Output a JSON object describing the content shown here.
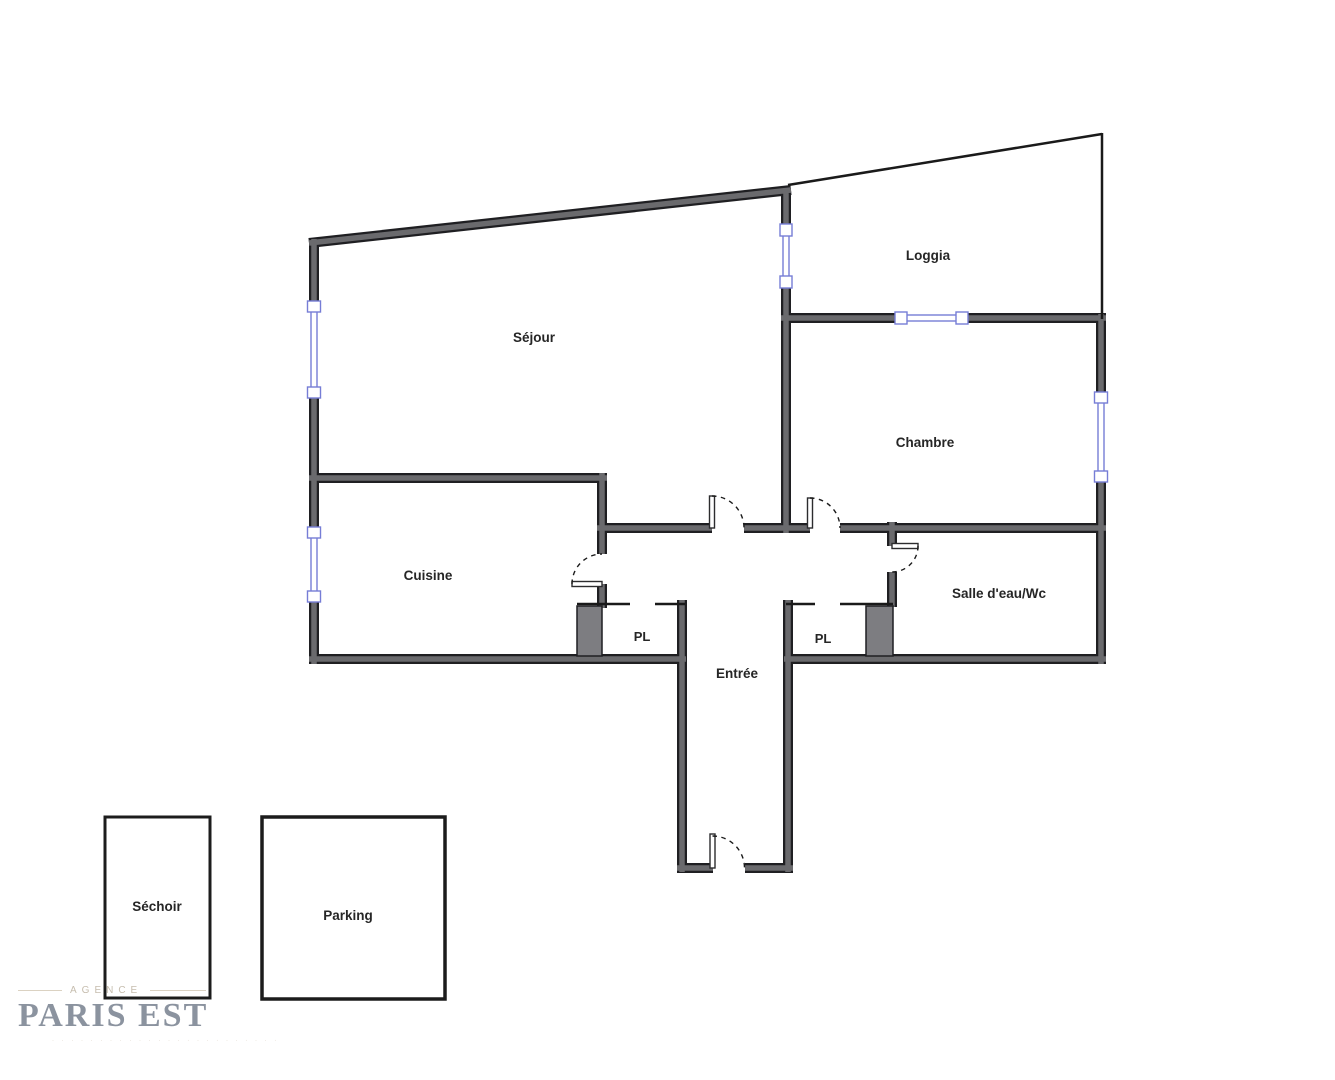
{
  "plan": {
    "rooms": {
      "sejour": "Séjour",
      "loggia": "Loggia",
      "chambre": "Chambre",
      "cuisine": "Cuisine",
      "salle_eau": "Salle d'eau/Wc",
      "entree": "Entrée",
      "pl_left": "PL",
      "pl_right": "PL"
    },
    "annexes": {
      "sechoir": "Séchoir",
      "parking": "Parking"
    }
  },
  "logo": {
    "over_title": "AGENCE",
    "title": "PARIS EST",
    "tagline": "· · · · · · · · · · · · · · · · · · · · · · · ·"
  },
  "colors": {
    "wall_outline": "#1f1f22",
    "wall_core": "#6a6a6d",
    "thin_wall": "#1a1a1a",
    "window_blue": "#767dd6",
    "window_fill": "#ffffff",
    "door_arc": "#1a1a1a",
    "closet_fill": "#7d7d81",
    "label_text": "#262626",
    "box_border": "#1c1c1c",
    "logo_title": "#8b939f",
    "logo_accent": "#c6bdae"
  }
}
